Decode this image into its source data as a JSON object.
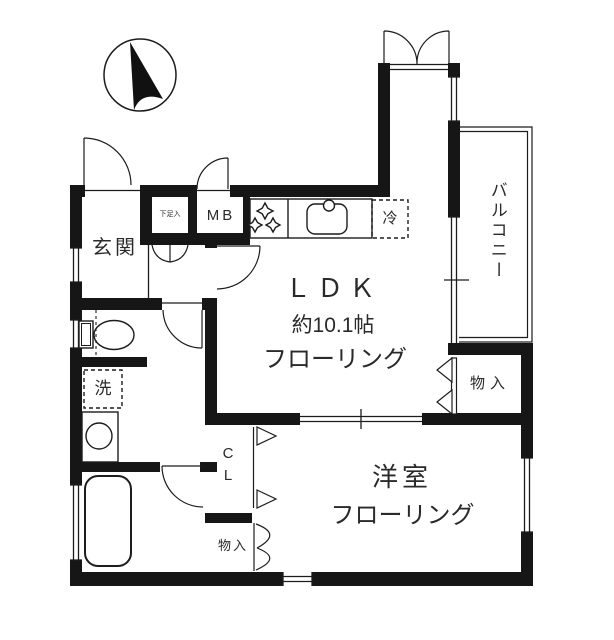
{
  "document": {
    "type": "floor-plan",
    "background": "#ffffff"
  },
  "colors": {
    "walls": "#161616",
    "lines": "#1c1c1c",
    "text": "#2a2a2a"
  },
  "labels": {
    "entrance": "玄関",
    "shoe_cabinet": "下足入",
    "meter_box": "MB",
    "refrigerator": "冷",
    "ldk_name": "ＬＤＫ",
    "ldk_size": "約10.1帖",
    "ldk_floor": "フローリング",
    "balcony": "バルコニー",
    "storage_right": "物入",
    "closet": "CL",
    "washer": "洗",
    "western_room_name": "洋室",
    "western_room_floor": "フローリング",
    "storage_bottom": "物入"
  },
  "icons": {
    "compass": "north-arrow-icon",
    "toilet": "toilet-icon",
    "bathtub": "bathtub-icon",
    "sink": "kitchen-sink-icon",
    "stove": "stove-burners-icon",
    "washbasin": "washbasin-icon"
  }
}
